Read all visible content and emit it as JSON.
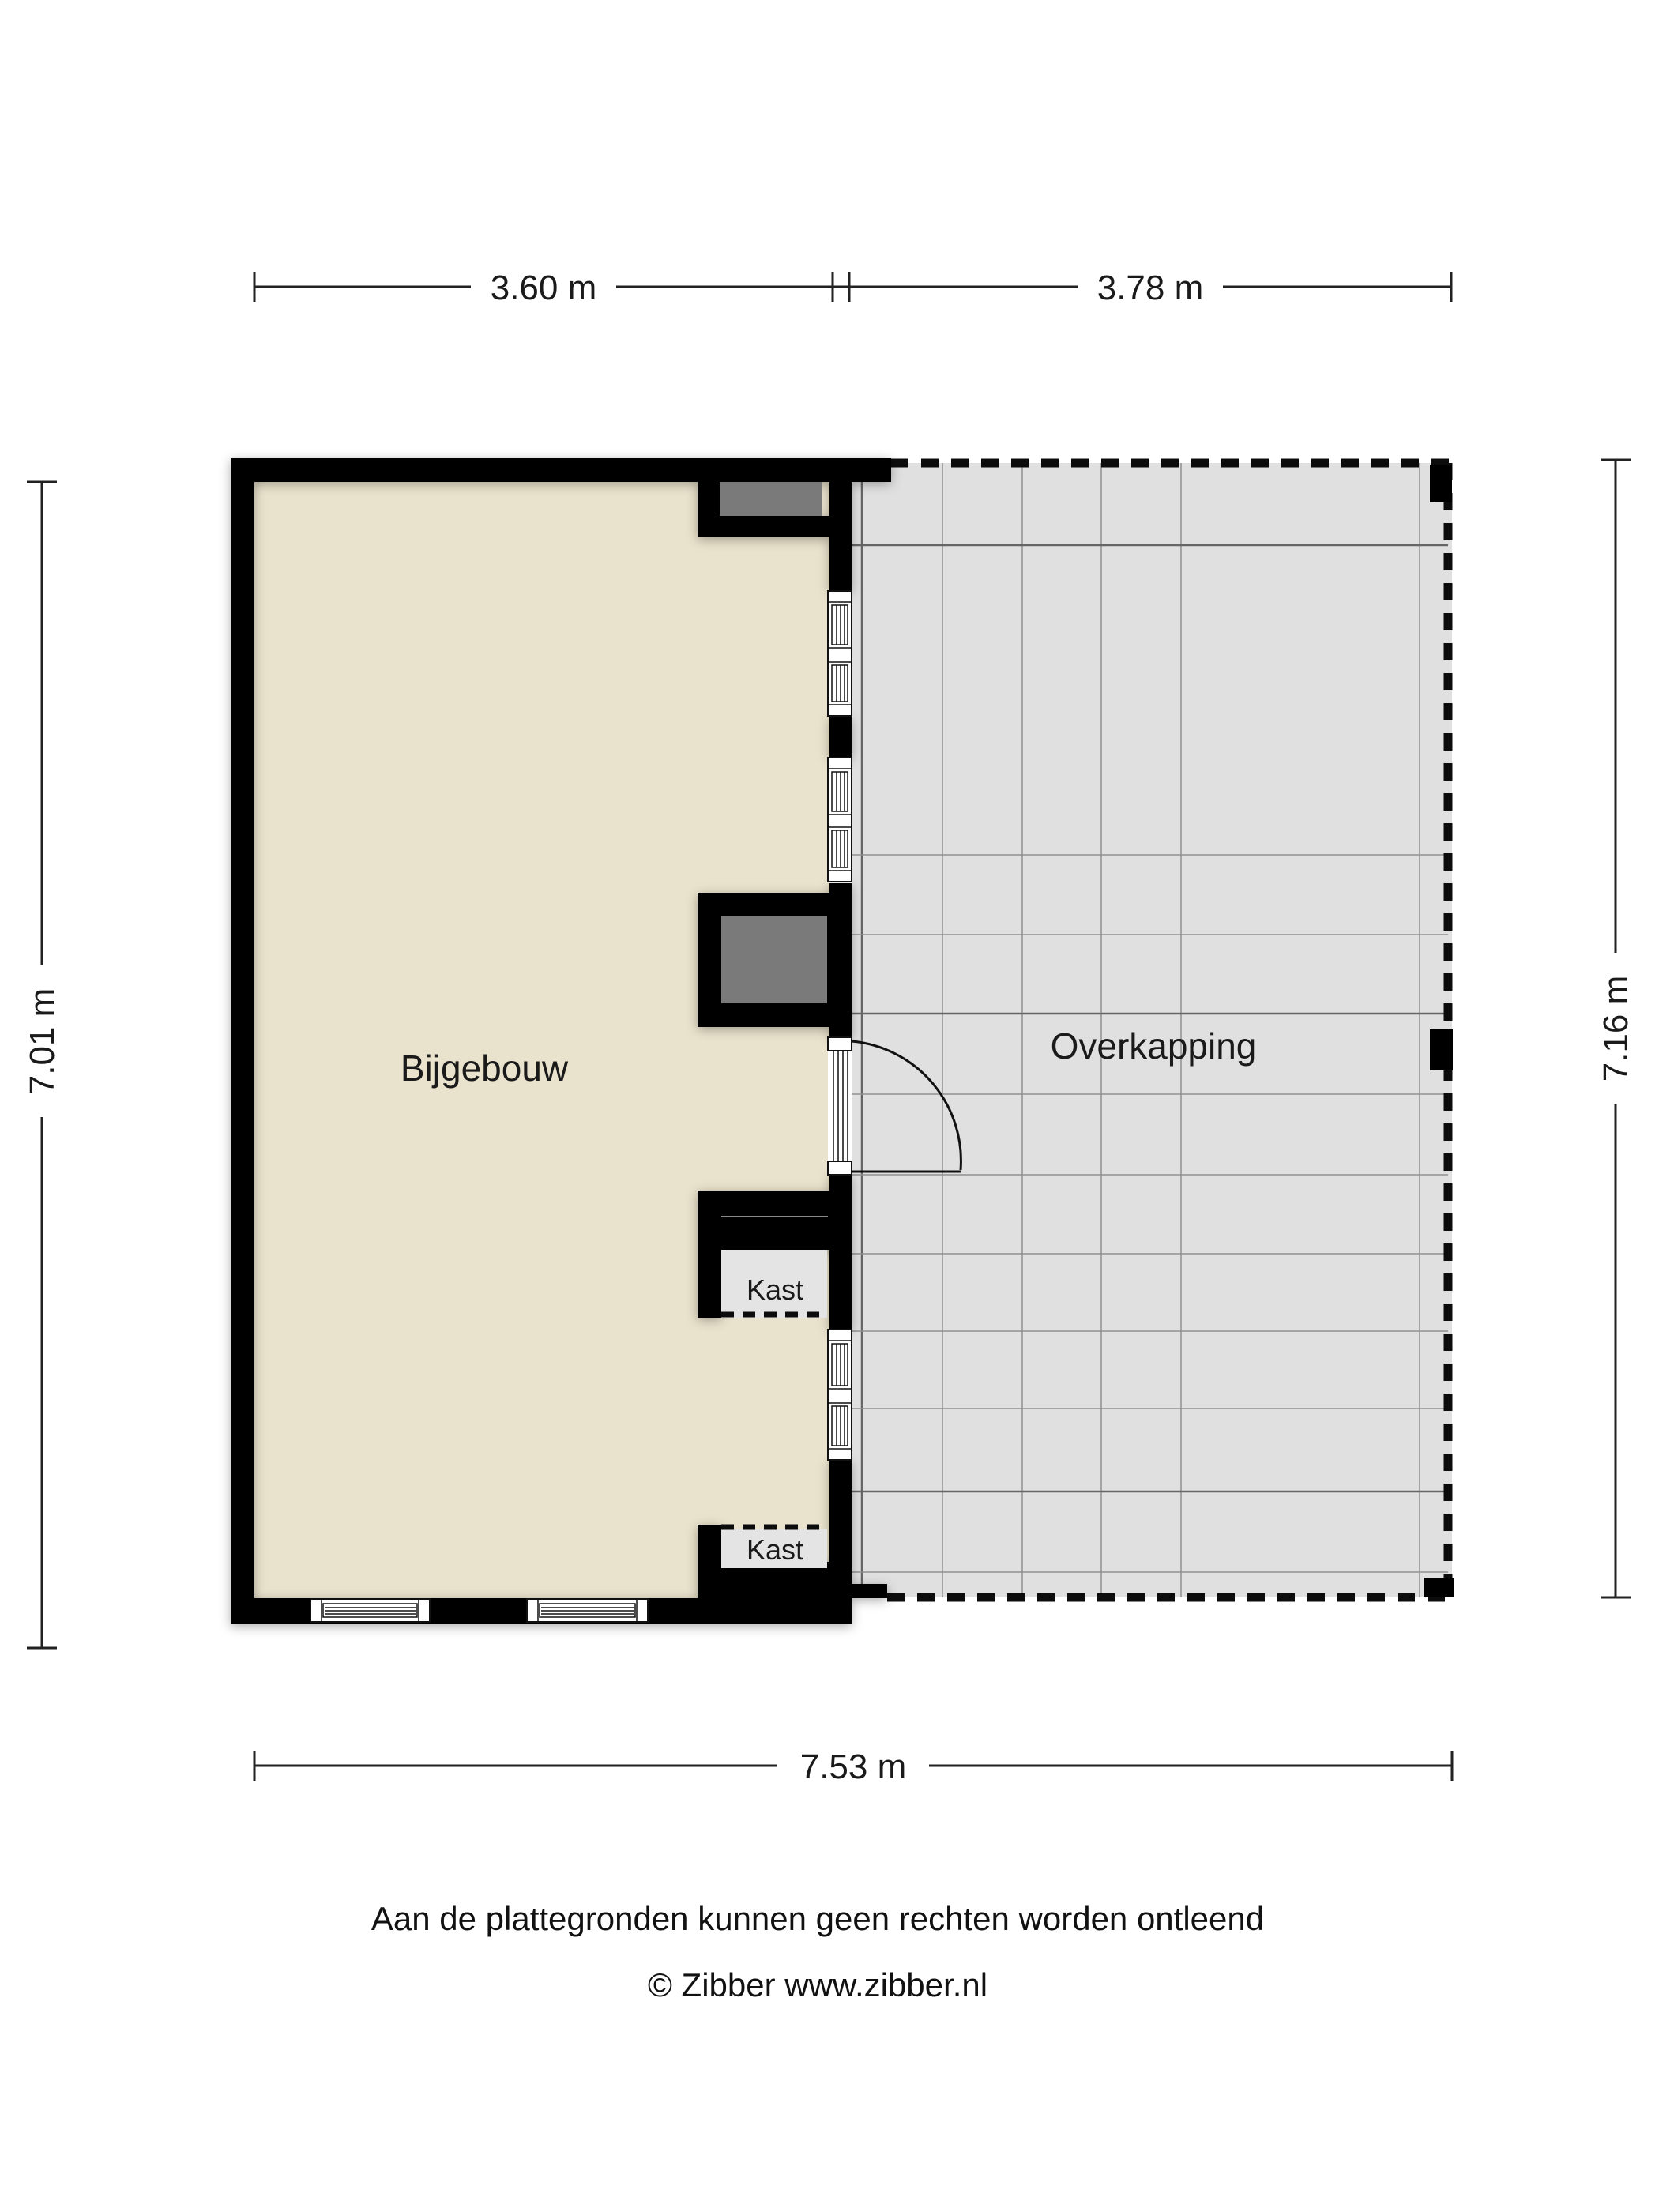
{
  "plan": {
    "title": "Floor plan (plattegrond)",
    "rooms": {
      "bijgebouw_label": "Bijgebouw",
      "overkapping_label": "Overkapping",
      "closet_top_label": "Kast",
      "closet_bottom_label": "Kast"
    },
    "dimensions": {
      "top_left_width": "3.60 m",
      "top_right_width": "3.78 m",
      "left_height": "7.01 m",
      "right_height": "7.16 m",
      "bottom_width": "7.53 m"
    }
  },
  "footer": {
    "disclaimer": "Aan de plattegronden kunnen geen rechten worden ontleend",
    "copyright": "© Zibber www.zibber.nl"
  },
  "colors": {
    "wall": "#000000",
    "bijgebouw_floor": "#e9e2cc",
    "overkapping_floor": "#e0e0e0",
    "niche_gray": "#7a7a7a",
    "closet_fill": "#e4e4e4",
    "grid_line": "#8f8f8f",
    "text": "#1a1a1a"
  }
}
